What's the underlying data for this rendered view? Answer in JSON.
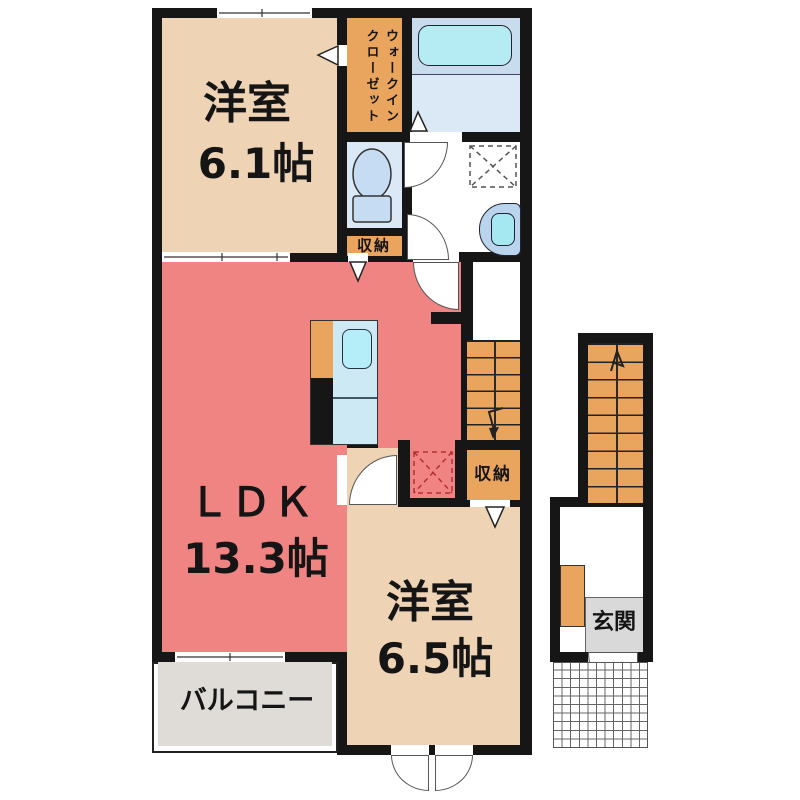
{
  "rooms": {
    "bedroom_top": {
      "name": "洋室",
      "size": "6.1帖"
    },
    "walk_in_closet": {
      "col_right": "ウォークイン",
      "col_left": "クローゼット"
    },
    "storage_upper": {
      "name": "収納"
    },
    "ldk": {
      "name": "ＬＤＫ",
      "size": "13.3帖"
    },
    "storage_lower": {
      "name": "収納"
    },
    "bedroom_bottom": {
      "name": "洋室",
      "size": "6.5帖"
    },
    "balcony": {
      "name": "バルコニー"
    },
    "entrance": {
      "name": "玄関"
    }
  },
  "colors": {
    "wall": "#161616",
    "room_beige": "#eed3b5",
    "ldk_red": "#f08482",
    "accent_orange": "#e9a55e",
    "bath_blue_upper": "#c9dcee",
    "bath_blue_lower": "#dbe8f5",
    "fixture_cyan": "#b5ecf4",
    "fixture_blue": "#c6dcf2",
    "kitchen_blue": "#cde9f4",
    "balcony_gray": "#dfdbd7",
    "entrance_gray": "#d9d9d9",
    "fridge_dash_red": "#b43030"
  }
}
